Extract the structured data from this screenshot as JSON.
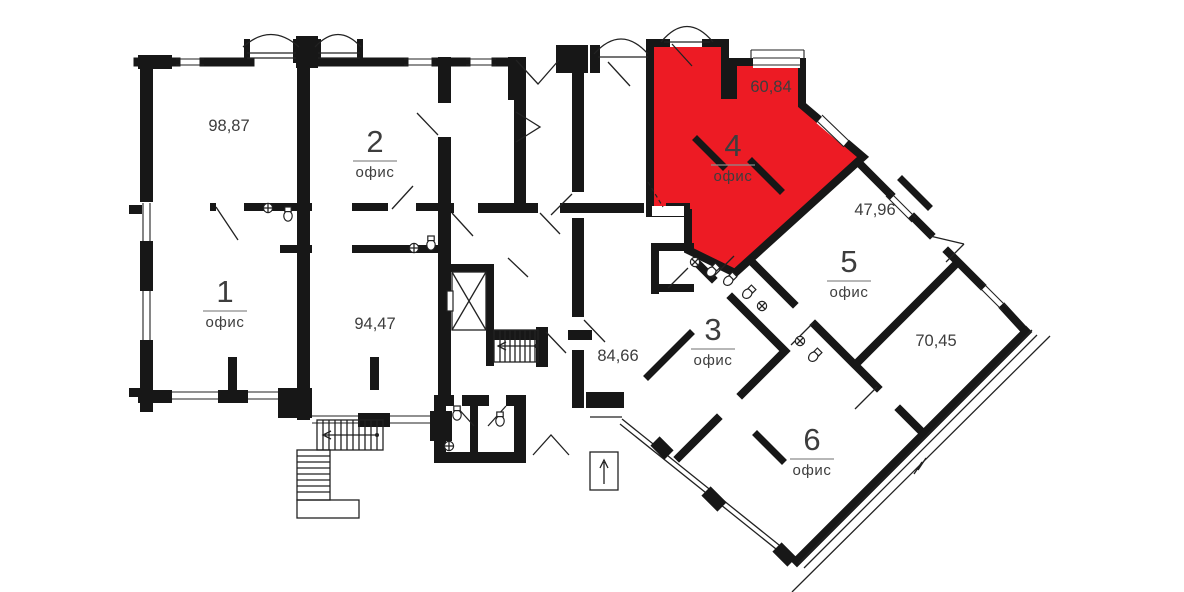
{
  "colors": {
    "highlight": "#ed1b24",
    "wall": "#171717",
    "label": "#3d3d3d"
  },
  "rooms": [
    {
      "id": "office-1",
      "number": "1",
      "type": "офис",
      "area": "98,87",
      "highlighted": false
    },
    {
      "id": "office-2",
      "number": "2",
      "type": "офис",
      "area": "94,47",
      "highlighted": false
    },
    {
      "id": "office-3",
      "number": "3",
      "type": "офис",
      "area": "84,66",
      "highlighted": false
    },
    {
      "id": "office-4",
      "number": "4",
      "type": "офис",
      "area": "60,84",
      "highlighted": true
    },
    {
      "id": "office-5",
      "number": "5",
      "type": "офис",
      "area": "47,96",
      "highlighted": false
    },
    {
      "id": "office-6",
      "number": "6",
      "type": "офис",
      "area": "70,45",
      "highlighted": false
    }
  ]
}
